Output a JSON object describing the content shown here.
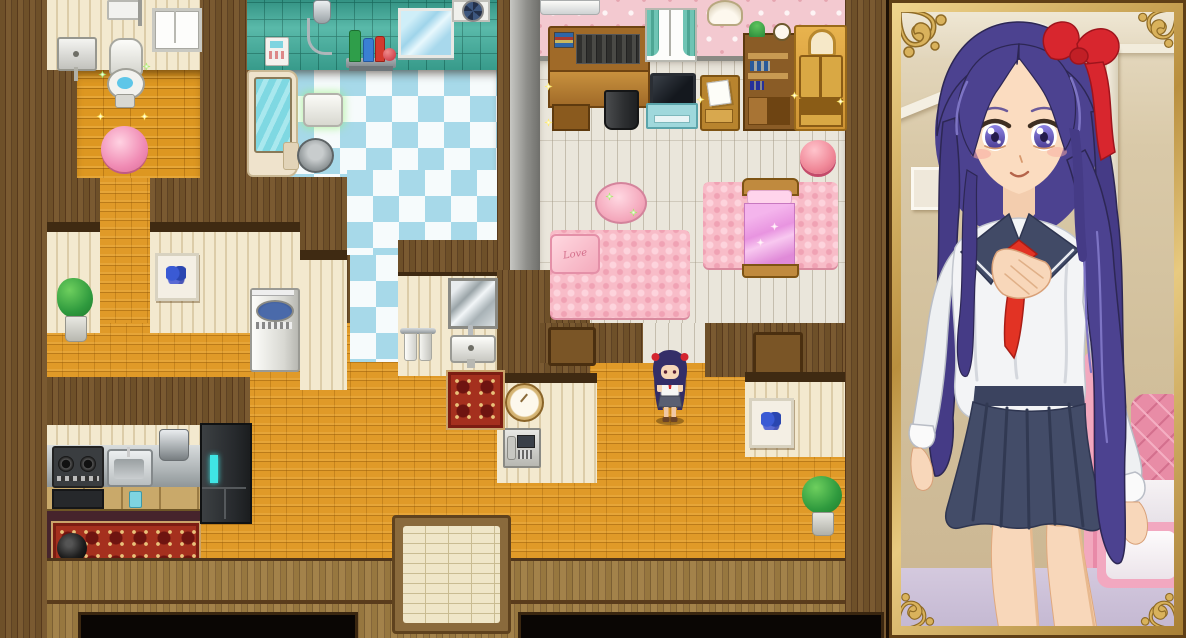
{
  "window": {
    "width": 1186,
    "height": 638,
    "kind": "rpg-maker-style game screenshot",
    "view": "top-down house interior with character portrait panel"
  },
  "map": {
    "rooms": [
      {
        "name": "toilet-room",
        "wall": "cream striped wallpaper",
        "floor": "orange wood planks",
        "items": [
          "water-heater",
          "window",
          "wall-sink",
          "toilet",
          "pink-round-rug",
          "sparkles"
        ]
      },
      {
        "name": "bathroom",
        "wall": "teal tiles",
        "floor": "blue-white checker tiles",
        "items": [
          "shower-unit",
          "bath-control-panel",
          "shampoo-shelf-bottles",
          "bath-mirror",
          "ventilation-fan",
          "bathtub",
          "bucket",
          "bath-stool"
        ]
      },
      {
        "name": "bedroom",
        "wall": "pink floral wallpaper",
        "floor": "white planks",
        "items": [
          "air-conditioner",
          "study-desk-with-books",
          "trash-bin",
          "curtained-window",
          "tv-on-stand",
          "small-wall-clock",
          "letter-desk",
          "bookshelf-with-plant-and-clock",
          "golden-wardrobe",
          "pink-pouf",
          "pink-dressing-table",
          "love-rug",
          "love-pillow",
          "pink-bed",
          "bed-rug",
          "door-left",
          "door-right"
        ]
      },
      {
        "name": "hallway",
        "floor": "orange brick",
        "items": [
          "potted-plant-left",
          "butterfly-picture-left",
          "washing-machine",
          "butterfly-picture-right",
          "potted-plant-right",
          "hall-clock",
          "intercom-phone",
          "entry-doormat"
        ]
      },
      {
        "name": "washroom",
        "wall": "cream wallpaper",
        "items": [
          "washroom-mirror",
          "towel-rack",
          "washroom-sink",
          "small-red-rug"
        ]
      },
      {
        "name": "kitchen",
        "wall": "cream backsplash",
        "floor": "dark maroon",
        "items": [
          "gas-stove",
          "kitchen-sink",
          "cooking-pot",
          "blue-cup",
          "refrigerator",
          "red-carpet",
          "iron-pot"
        ]
      }
    ],
    "player": {
      "description": "chibi girl sprite - dark purple hair, red hair bows, white top, grey skirt",
      "x": 648,
      "y": 350
    },
    "labels": {
      "love_pillow": "Love"
    }
  },
  "portrait": {
    "frame": "ornate gold frame with floral corner flourishes",
    "character": {
      "hair": "long purple hair",
      "accessory": "large red hair bow",
      "eyes": "violet",
      "outfit": "white sailor school uniform, navy collar, red necktie, navy pleated skirt",
      "pose": "smiling, right hand on chest"
    },
    "background": [
      "ceiling-light",
      "crown-molding",
      "picture-frame",
      "door-frame",
      "pink-canopy",
      "pink-tufted-headboard",
      "frilled-pillow",
      "lavender-floor"
    ]
  },
  "colors": {
    "wall_wood": "#64482a",
    "floor_orange": "#dd9721",
    "checker_blue": "#a7d9e9",
    "tile_teal": "#43b09e",
    "wallpaper_pink": "#f3c9d0",
    "plank_white": "#eae6db",
    "rug_pink": "#f8bcc8",
    "rug_red": "#a5301e",
    "frame_gold": "#d9b35c",
    "hair_purple": "#4c4290",
    "uniform_navy": "#434c68",
    "tie_red": "#e23324"
  }
}
